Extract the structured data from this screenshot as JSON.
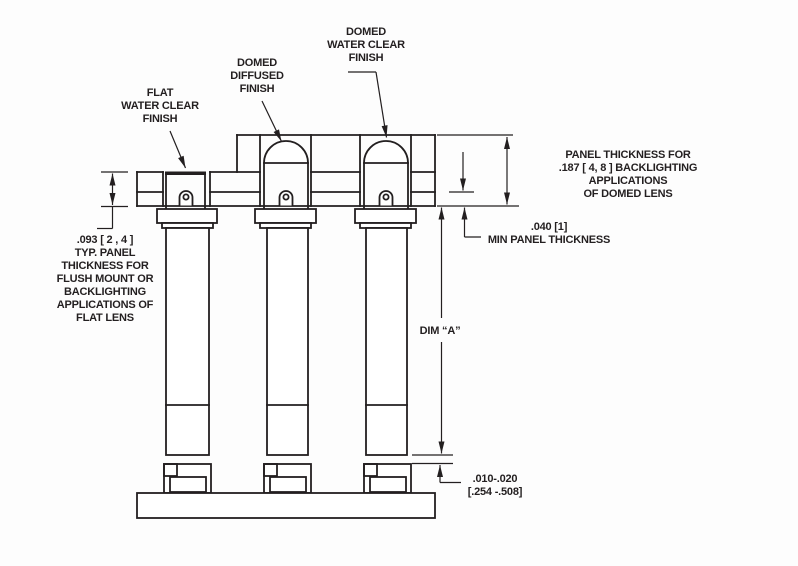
{
  "drawing": {
    "title": "Panel mount LED lens cross-section drawing",
    "colors": {
      "line": "#231f20",
      "background": "#fdfdfd"
    },
    "labels": {
      "flat_lens": "FLAT\nWATER CLEAR\nFINISH",
      "domed_diffused_lens": "DOMED\nDIFFUSED\nFINISH",
      "domed_water_clear_lens": "DOMED\nWATER CLEAR\nFINISH"
    },
    "dimensions": {
      "flat_panel_thickness": ".093 [ 2 , 4 ]\nTYP. PANEL\nTHICKNESS FOR\nFLUSH MOUNT OR\nBACKLIGHTING\nAPPLICATIONS OF\nFLAT LENS",
      "domed_panel_thickness": "PANEL THICKNESS FOR\n.187 [ 4, 8 ] BACKLIGHTING APPLICATIONS\nOF DOMED LENS",
      "min_panel_thickness": ".040 [1]\nMIN PANEL THICKNESS",
      "dim_a": "DIM “A”",
      "tip_gap": ".010-.020\n[.254 -.508]"
    }
  }
}
